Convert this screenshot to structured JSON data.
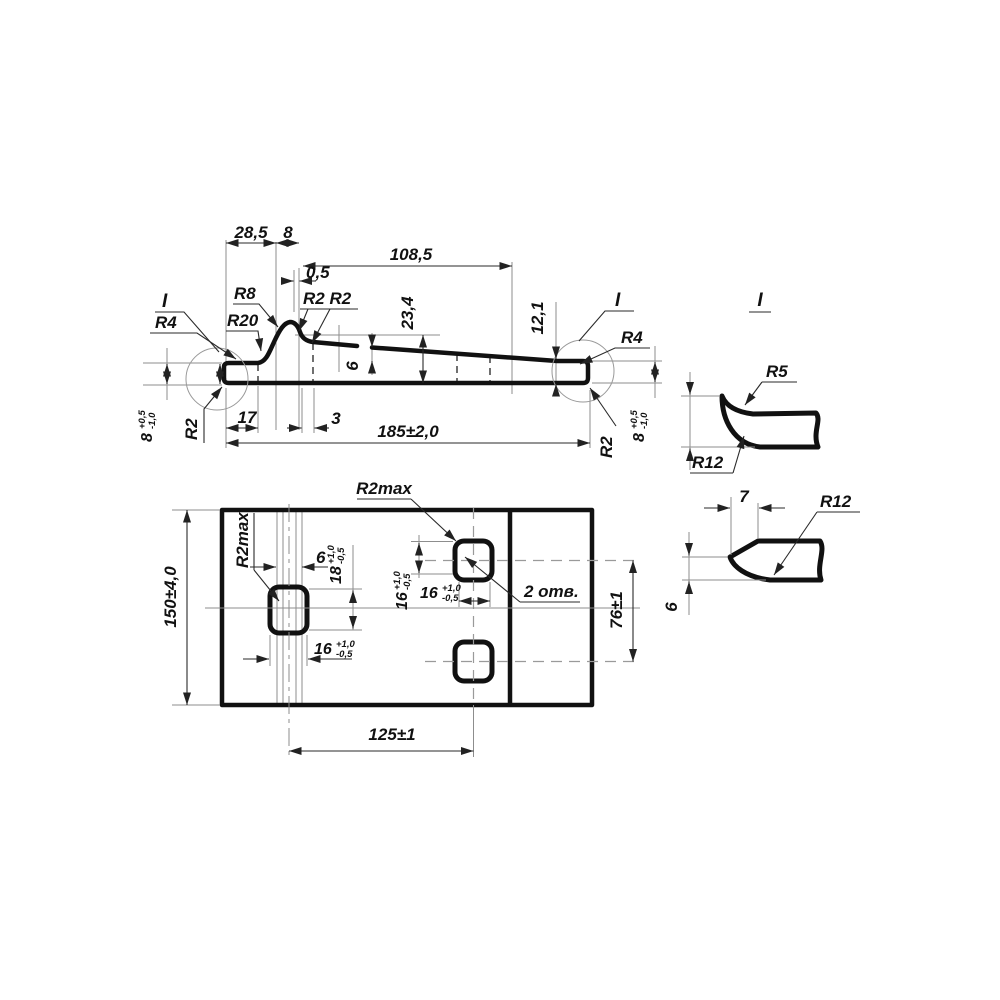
{
  "profile": {
    "w28_5": "28,5",
    "w8": "8",
    "w108_5": "108,5",
    "w0_5": "0,5",
    "h23_4": "23,4",
    "t6": "6",
    "h12_1": "12,1",
    "w17": "17",
    "w3": "3",
    "len": "185±2,0",
    "r4_left": "R4",
    "r20": "R20",
    "r8": "R8",
    "r2r2": "R2 R2",
    "r2_bottom_left": "R2",
    "r2_bottom_right": "R2",
    "r4_right": "R4",
    "detail_ref_left": "I",
    "detail_ref_right": "I",
    "h8_left": {
      "v": "8",
      "sup": "+0,5",
      "sub": "-1,0"
    },
    "h8_right": {
      "v": "8",
      "sup": "+0,5",
      "sub": "-1,0"
    }
  },
  "plan": {
    "h150": "150±4,0",
    "w125": "125±1",
    "h76": "76±1",
    "w6": "6",
    "h18": {
      "v": "18",
      "sup": "+1,0",
      "sub": "-0,5"
    },
    "w16_left": {
      "v": "16",
      "sup": "+1,0",
      "sub": "-0,5"
    },
    "h16_right": {
      "v": "16",
      "sup": "+1,0",
      "sub": "-0,5"
    },
    "w16_right": {
      "v": "16",
      "sup": "+1,0",
      "sub": "-0,5"
    },
    "r2max_top": "R2max",
    "r2max_left": "R2max",
    "holes_note": "2 отв."
  },
  "detail_top": {
    "title": "I",
    "r5": "R5",
    "r12": "R12"
  },
  "detail_bottom": {
    "w7": "7",
    "r12": "R12",
    "h6": "6"
  },
  "colors": {
    "ink": "#111111",
    "thin_line": "#8d8d8d",
    "background": "#ffffff"
  }
}
